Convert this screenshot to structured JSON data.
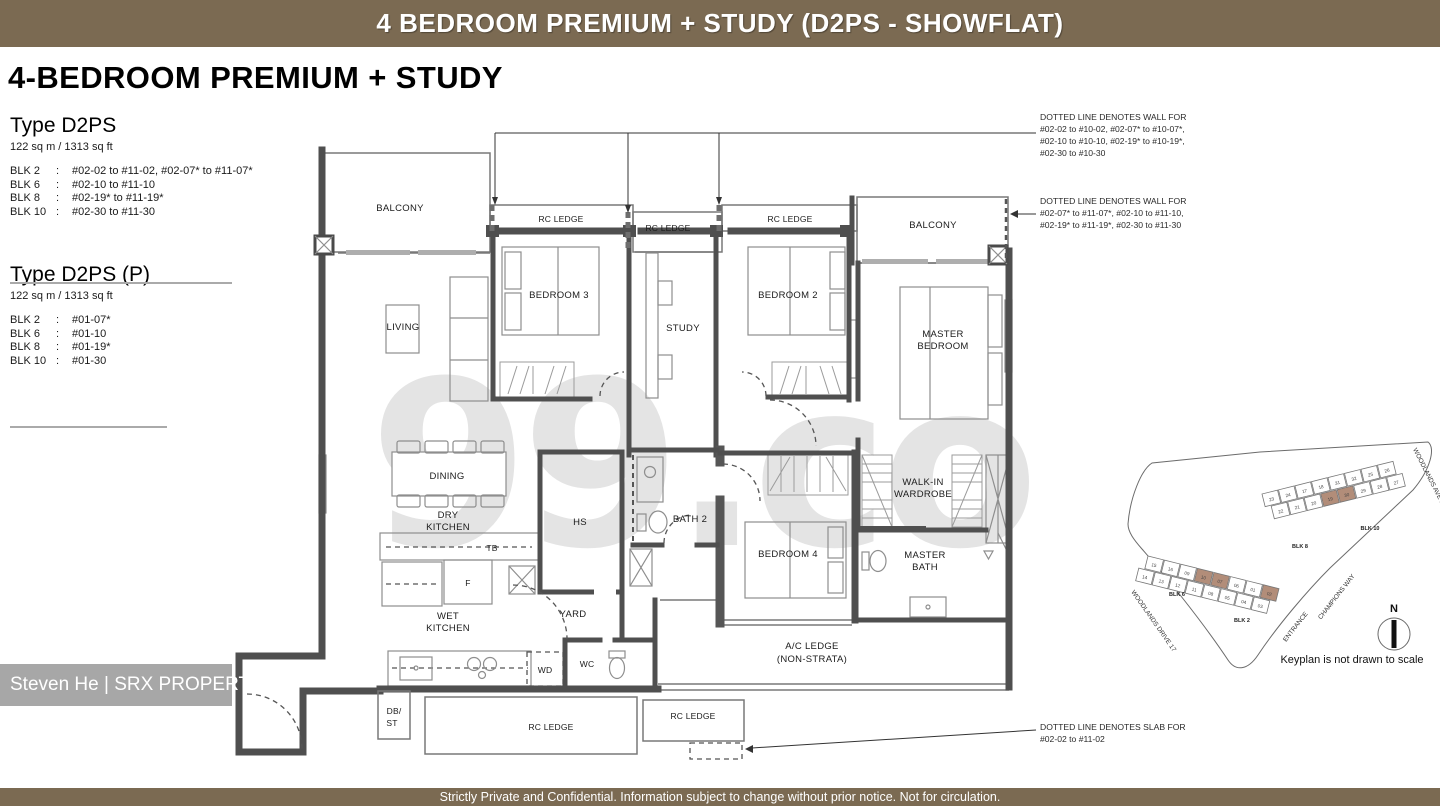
{
  "header": {
    "title": "4 BEDROOM PREMIUM + STUDY (D2PS - SHOWFLAT)"
  },
  "footer": {
    "text": "Strictly Private and Confidential. Information subject to change without prior notice. Not for circulation."
  },
  "info": {
    "page_title": "4-BEDROOM PREMIUM + STUDY",
    "type1": {
      "name": "Type D2PS",
      "area": "122 sq m /  1313 sq ft",
      "rows": [
        {
          "blk": "BLK 2",
          "colon": ":",
          "units": "#02-02 to #11-02, #02-07* to #11-07*"
        },
        {
          "blk": "BLK 6",
          "colon": ":",
          "units": "#02-10 to #11-10"
        },
        {
          "blk": "BLK 8",
          "colon": ":",
          "units": "#02-19* to #11-19*"
        },
        {
          "blk": "BLK 10",
          "colon": ":",
          "units": "#02-30 to #11-30"
        }
      ]
    },
    "type2": {
      "name": "Type D2PS (P)",
      "area": "122 sq m /  1313 sq ft",
      "rows": [
        {
          "blk": "BLK 2",
          "colon": ":",
          "units": "#01-07*"
        },
        {
          "blk": "BLK 6",
          "colon": ":",
          "units": "#01-10"
        },
        {
          "blk": "BLK 8",
          "colon": ":",
          "units": "#01-19*"
        },
        {
          "blk": "BLK 10",
          "colon": ":",
          "units": "#01-30"
        }
      ]
    }
  },
  "notes": {
    "wall_top": {
      "l1": "DOTTED LINE DENOTES WALL FOR",
      "l2": "#02-02 to #10-02, #02-07* to #10-07*,",
      "l3": "#02-10 to #10-10, #02-19* to #10-19*,",
      "l4": "#02-30 to #10-30"
    },
    "wall_right": {
      "l1": "DOTTED LINE DENOTES WALL FOR",
      "l2": "#02-07* to #11-07*, #02-10 to #11-10,",
      "l3": "#02-19* to #11-19*, #02-30 to #11-30"
    },
    "slab": {
      "l1": "DOTTED LINE DENOTES SLAB FOR",
      "l2": "#02-02 to #11-02"
    }
  },
  "plan": {
    "rooms": {
      "balcony_left": "BALCONY",
      "rc_ledge_1": "RC LEDGE",
      "rc_ledge_2": "RC LEDGE",
      "rc_ledge_3": "RC LEDGE",
      "balcony_right": "BALCONY",
      "living": "LIVING",
      "bedroom3": "BEDROOM 3",
      "study": "STUDY",
      "bedroom2": "BEDROOM 2",
      "master_1": "MASTER",
      "master_2": "BEDROOM",
      "dining": "DINING",
      "dry_1": "DRY",
      "dry_2": "KITCHEN",
      "tb": "TB",
      "hs": "HS",
      "bath2": "BATH 2",
      "walkin_1": "WALK-IN",
      "walkin_2": "WARDROBE",
      "bedroom4": "BEDROOM 4",
      "mbath_1": "MASTER",
      "mbath_2": "BATH",
      "fridge": "F",
      "wet_1": "WET",
      "wet_2": "KITCHEN",
      "yard": "YARD",
      "wd": "WD",
      "wc": "WC",
      "ac_1": "A/C LEDGE",
      "ac_2": "(NON-STRATA)",
      "dbst_1": "DB/",
      "dbst_2": "ST",
      "rc_bottom_1": "RC LEDGE",
      "rc_bottom_2": "RC LEDGE"
    }
  },
  "keyplan": {
    "caption": "Keyplan is not drawn to scale",
    "north": "N",
    "streets": {
      "ave": "WOODLANDS AVE 1",
      "drive": "WOODLANDS DRIVE 17",
      "champions": "CHAMPIONS WAY",
      "entrance": "ENTRANCE"
    },
    "blks": {
      "blk8": "BLK 8",
      "blk10": "BLK 10",
      "blk6": "BLK 6",
      "blk2": "BLK 2"
    },
    "top_units_back": [
      "23",
      "24",
      "17",
      "18",
      "31",
      "32",
      "25",
      "26"
    ],
    "top_units_front": [
      "22",
      "21",
      "20",
      "19",
      "30",
      "29",
      "28",
      "27"
    ],
    "bottom_units_back": [
      "15",
      "16",
      "09",
      "10",
      "07",
      "06",
      "01",
      "02"
    ],
    "bottom_units_front": [
      "14",
      "13",
      "12",
      "11",
      "08",
      "05",
      "04",
      "03"
    ],
    "highlight_color": "#b28d79"
  },
  "watermark": {
    "agent": "Steven He | SRX PROPERTY",
    "logo": "99.co"
  },
  "colors": {
    "brand_brown": "#7b6a52"
  }
}
